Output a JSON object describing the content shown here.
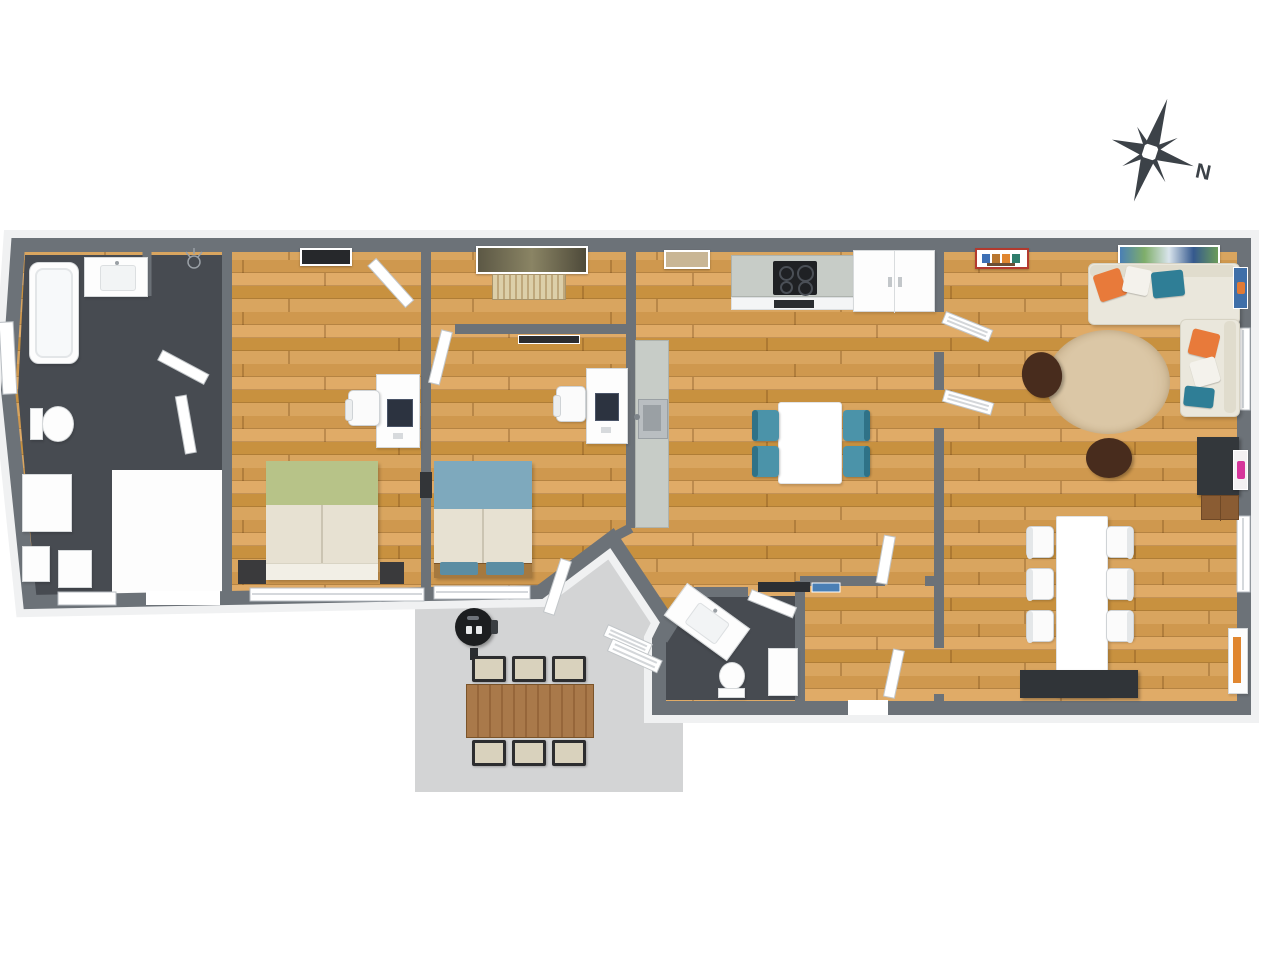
{
  "title": "apartment-floor-plan-3d-top-view",
  "compass": {
    "label": "N"
  },
  "colors": {
    "wall": "#6c7278",
    "halo": "#f0f1f2",
    "darkfloor": "#474b51",
    "patio": "#d3d4d5",
    "counter": "#c7ccc7",
    "compass": "#3c4248",
    "teal": "#4b93a9",
    "orange": "#e87a3a",
    "greenbed": "#b7c388",
    "bluebed": "#7ea9bd",
    "beige": "#e7e1d2",
    "sofa": "#eae7dc",
    "sofaedge": "#d7d3c4",
    "rug": "#dbc7a6",
    "pouf": "#482c1d",
    "tv": "#33373b",
    "sideboard": "#303438",
    "grill": "#1c1e20",
    "wood1": "#d9a55f",
    "wood2": "#cf984e",
    "wood3": "#e0ab67",
    "wood4": "#c8913f"
  },
  "rooms": [
    {
      "id": "bathroom",
      "floor": "dark-tile",
      "furniture": [
        "bathtub",
        "vanity-sink",
        "toilet",
        "washer",
        "storage-boxes",
        "ceiling-light-sketch",
        "open-doors"
      ]
    },
    {
      "id": "bedroom-1",
      "floor": "wood",
      "furniture": [
        "wall-art",
        "desk",
        "monitor",
        "office-chair",
        "double-bed-green",
        "nightstand-left",
        "nightstand-right",
        "window"
      ]
    },
    {
      "id": "bedroom-2",
      "floor": "wood",
      "furniture": [
        "wall-art-large",
        "radiator",
        "wall-art-small",
        "desk",
        "monitor",
        "office-chair",
        "double-bed-blue",
        "bench-with-cushions",
        "terrace-door",
        "window"
      ]
    },
    {
      "id": "kitchen-dining",
      "floor": "wood",
      "furniture": [
        "wall-art",
        "kitchen-counter",
        "cooktop",
        "oven",
        "tall-cabinet-fridge",
        "island-with-sink",
        "dining-table",
        "teal-chair-x4",
        "patio-door"
      ]
    },
    {
      "id": "living-room",
      "floor": "wood",
      "furniture": [
        "red-frame-art",
        "canvas-art",
        "sectional-sofa",
        "throw-pillows",
        "round-rug",
        "pouf-x2",
        "tv-stand",
        "media-drawer",
        "long-dining-table",
        "white-chair-x6",
        "sideboard",
        "display-cabinet",
        "louver-door-x2",
        "window-x2",
        "wall-art-blue",
        "wall-art-pink"
      ]
    },
    {
      "id": "wc",
      "floor": "dark-tile",
      "furniture": [
        "vanity-sink",
        "toilet",
        "wall-shelf",
        "doormat",
        "cabinet",
        "door"
      ]
    },
    {
      "id": "hallway",
      "floor": "wood",
      "furniture": [
        "interior-doors",
        "front-door-opening"
      ]
    },
    {
      "id": "patio",
      "floor": "concrete",
      "furniture": [
        "bbq-grill",
        "outdoor-dining-table",
        "outdoor-chair-x6",
        "railing"
      ]
    }
  ]
}
